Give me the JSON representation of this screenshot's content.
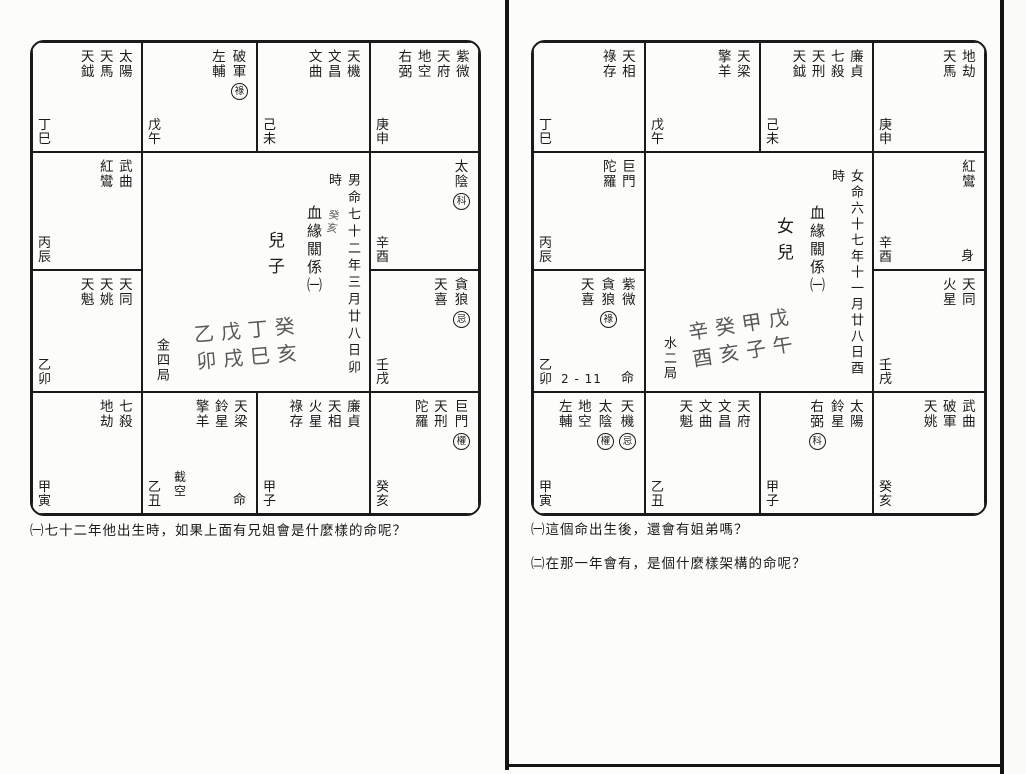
{
  "colors": {
    "ink": "#1b1b1b",
    "paper": "#fcfcfa",
    "handwriting": "#585858"
  },
  "left_page": {
    "chart": {
      "cells": [
        {
          "row": 1,
          "col": 1,
          "branch": "丁巳",
          "stars": [
            {
              "name": "太陽"
            },
            {
              "name": "天馬"
            },
            {
              "name": "天鉞"
            }
          ]
        },
        {
          "row": 1,
          "col": 2,
          "branch": "戊午",
          "stars": [
            {
              "name": "破軍",
              "mark": "祿"
            },
            {
              "name": "左輔"
            }
          ]
        },
        {
          "row": 1,
          "col": 3,
          "branch": "己未",
          "stars": [
            {
              "name": "天機"
            },
            {
              "name": "文昌"
            },
            {
              "name": "文曲"
            }
          ]
        },
        {
          "row": 1,
          "col": 4,
          "branch": "庚申",
          "stars": [
            {
              "name": "紫微"
            },
            {
              "name": "天府"
            },
            {
              "name": "地空"
            },
            {
              "name": "右弼"
            }
          ]
        },
        {
          "row": 2,
          "col": 1,
          "branch": "丙辰",
          "stars": [
            {
              "name": "武曲"
            },
            {
              "name": "紅鸞"
            }
          ]
        },
        {
          "row": 2,
          "col": 4,
          "branch": "辛酉",
          "stars": [
            {
              "name": "太陰",
              "mark": "科"
            }
          ]
        },
        {
          "row": 3,
          "col": 1,
          "branch": "乙卯",
          "stars": [
            {
              "name": "天同"
            },
            {
              "name": "天姚"
            },
            {
              "name": "天魁"
            }
          ]
        },
        {
          "row": 3,
          "col": 4,
          "branch": "壬戌",
          "stars": [
            {
              "name": "貪狼",
              "mark": "忌"
            },
            {
              "name": "天喜"
            }
          ]
        },
        {
          "row": 4,
          "col": 1,
          "branch": "甲寅",
          "stars": [
            {
              "name": "七殺"
            },
            {
              "name": "地劫"
            }
          ]
        },
        {
          "row": 4,
          "col": 2,
          "branch": "乙丑",
          "stars": [
            {
              "name": "天梁"
            },
            {
              "name": "鈴星"
            },
            {
              "name": "擎羊"
            }
          ],
          "extras": [
            {
              "text": "截空",
              "cls": "extra-vert"
            },
            {
              "text": "命",
              "cls": "extra-br"
            }
          ]
        },
        {
          "row": 4,
          "col": 3,
          "branch": "甲子",
          "stars": [
            {
              "name": "廉貞"
            },
            {
              "name": "天相"
            },
            {
              "name": "火星"
            },
            {
              "name": "祿存"
            }
          ]
        },
        {
          "row": 4,
          "col": 4,
          "branch": "癸亥",
          "stars": [
            {
              "name": "巨門",
              "mark": "權"
            },
            {
              "name": "天刑"
            },
            {
              "name": "陀羅"
            }
          ]
        }
      ],
      "center": {
        "birth_info": "男命七十二年三月廿八日卯時",
        "hand_note": "癸亥",
        "relation_title": "血緣關係㈠",
        "subject": "兒子",
        "hand_pillars_top": "乙戊丁癸",
        "hand_pillars_bottom": "卯戌巳亥",
        "bureau": "金四局"
      }
    },
    "questions": [
      "㈠七十二年他出生時，如果上面有兄姐會是什麼樣的命呢？"
    ]
  },
  "right_page": {
    "chart": {
      "cells": [
        {
          "row": 1,
          "col": 1,
          "branch": "丁巳",
          "stars": [
            {
              "name": "天相"
            },
            {
              "name": "祿存"
            }
          ]
        },
        {
          "row": 1,
          "col": 2,
          "branch": "戊午",
          "stars": [
            {
              "name": "天梁"
            },
            {
              "name": "擎羊"
            }
          ]
        },
        {
          "row": 1,
          "col": 3,
          "branch": "己未",
          "stars": [
            {
              "name": "廉貞"
            },
            {
              "name": "七殺"
            },
            {
              "name": "天刑"
            },
            {
              "name": "天鉞"
            }
          ]
        },
        {
          "row": 1,
          "col": 4,
          "branch": "庚申",
          "stars": [
            {
              "name": "地劫"
            },
            {
              "name": "天馬"
            }
          ]
        },
        {
          "row": 2,
          "col": 1,
          "branch": "丙辰",
          "stars": [
            {
              "name": "巨門"
            },
            {
              "name": "陀羅"
            }
          ]
        },
        {
          "row": 2,
          "col": 4,
          "branch": "辛酉",
          "stars": [
            {
              "name": "紅鸞"
            }
          ],
          "extras": [
            {
              "text": "身",
              "cls": "extra-br"
            }
          ]
        },
        {
          "row": 3,
          "col": 1,
          "branch": "乙卯",
          "stars": [
            {
              "name": "紫微"
            },
            {
              "name": "貪狼",
              "mark": "祿"
            },
            {
              "name": "天喜"
            }
          ],
          "extras": [
            {
              "text": "2 - 11",
              "cls": "extra-range"
            },
            {
              "text": "命",
              "cls": "extra-br"
            }
          ]
        },
        {
          "row": 3,
          "col": 4,
          "branch": "壬戌",
          "stars": [
            {
              "name": "天同"
            },
            {
              "name": "火星"
            }
          ]
        },
        {
          "row": 4,
          "col": 1,
          "branch": "甲寅",
          "stars": [
            {
              "name": "天機",
              "mark": "忌"
            },
            {
              "name": "太陰",
              "mark": "權"
            },
            {
              "name": "地空"
            },
            {
              "name": "左輔"
            }
          ]
        },
        {
          "row": 4,
          "col": 2,
          "branch": "乙丑",
          "stars": [
            {
              "name": "天府"
            },
            {
              "name": "文昌"
            },
            {
              "name": "文曲"
            },
            {
              "name": "天魁"
            }
          ]
        },
        {
          "row": 4,
          "col": 3,
          "branch": "甲子",
          "stars": [
            {
              "name": "太陽"
            },
            {
              "name": "鈴星"
            },
            {
              "name": "右弼",
              "mark": "科"
            }
          ]
        },
        {
          "row": 4,
          "col": 4,
          "branch": "癸亥",
          "stars": [
            {
              "name": "武曲"
            },
            {
              "name": "破軍"
            },
            {
              "name": "天姚"
            }
          ]
        }
      ],
      "center": {
        "birth_info": "女命六十七年十一月廿八日酉時",
        "relation_title": "血緣關係㈠",
        "subject": "女兒",
        "hand_pillars_top": "辛癸甲戊",
        "hand_pillars_bottom": "酉亥子午",
        "bureau": "水二局"
      }
    },
    "questions": [
      "㈠這個命出生後，還會有姐弟嗎？",
      "㈡在那一年會有，是個什麼樣架構的命呢？"
    ]
  }
}
